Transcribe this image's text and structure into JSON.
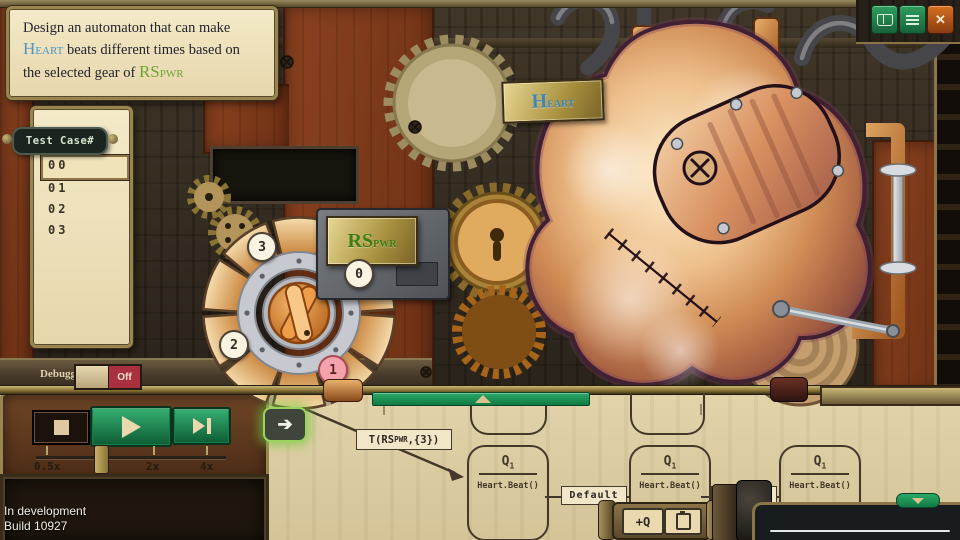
{
  "window": {
    "buttons": [
      {
        "name": "manual",
        "icon": "book-icon"
      },
      {
        "name": "menu",
        "icon": "hamburger-icon"
      },
      {
        "name": "close",
        "icon": "x-icon",
        "glyph": "✕"
      }
    ]
  },
  "instruction": {
    "part1": "Design an automaton that can make ",
    "heart_big": "H",
    "heart_small": "EART",
    "part2": " beats different times based on the selected gear of ",
    "rs_big": "RS",
    "rs_small": "PWR"
  },
  "test_cases": {
    "title": "Test Case#",
    "items": [
      {
        "label": "00",
        "selected": true
      },
      {
        "label": "01",
        "selected": false
      },
      {
        "label": "02",
        "selected": false
      },
      {
        "label": "03",
        "selected": false
      }
    ]
  },
  "machine_labels": {
    "heart_big": "H",
    "heart_small": "EART",
    "rs_big": "RS",
    "rs_small": "PWR"
  },
  "gear_selector": {
    "badges": [
      {
        "label": "0",
        "selected": false
      },
      {
        "label": "1",
        "selected": true
      },
      {
        "label": "2",
        "selected": false
      },
      {
        "label": "3",
        "selected": false
      }
    ]
  },
  "debugger": {
    "label": "Debugger",
    "state": "Off"
  },
  "transport": {
    "speed_labels": [
      "0.5x",
      "2x",
      "4x"
    ]
  },
  "flow": {
    "tooltip_prefix": "T(RS",
    "tooltip_sub": "PWR",
    "tooltip_suffix": ",{3})",
    "edges": [
      {
        "label": "Default"
      },
      {
        "label": "Default"
      }
    ],
    "nodes": [
      {
        "title": "Q",
        "sub": "1",
        "body": "Heart.Beat()"
      },
      {
        "title": "Q",
        "sub": "1",
        "body": "Heart.Beat()"
      },
      {
        "title": "Q",
        "sub": "1",
        "body": "Heart.Beat()"
      }
    ]
  },
  "node_toolbar": {
    "add_state": "+Q"
  },
  "footer": {
    "line1": "In development",
    "line2": "Build 10927"
  },
  "colors": {
    "accent_green": "#1e9e63",
    "parchment": "#e2d3ab",
    "brass": "#9a8450",
    "selected_pink": "#f4a3ac",
    "toggle_off_red": "#a8303f",
    "heart_blue": "#4796c6",
    "rs_green": "#6fa52e"
  }
}
